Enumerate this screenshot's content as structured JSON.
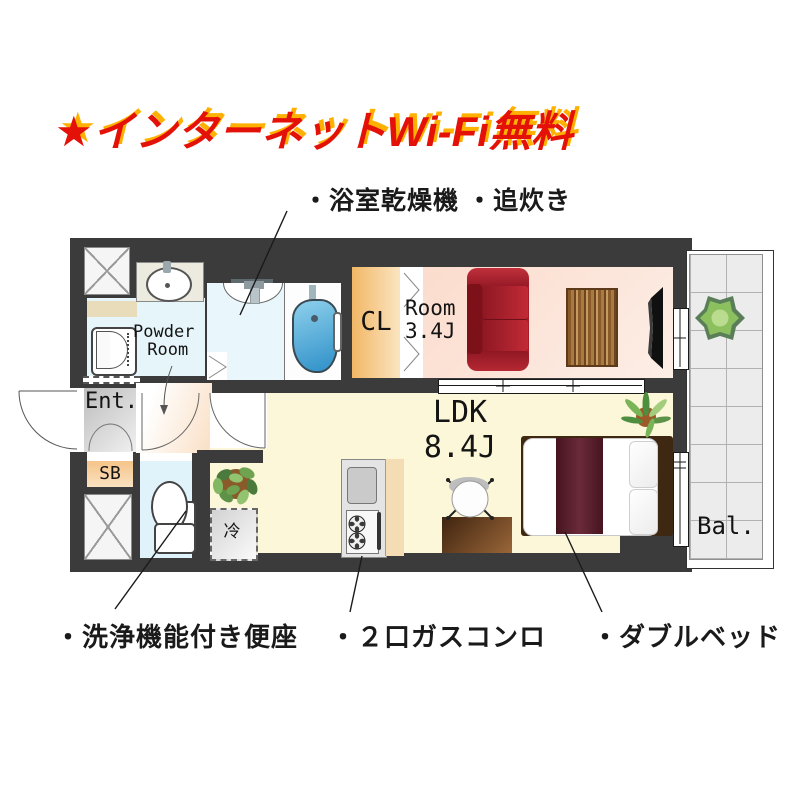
{
  "header": {
    "title": "★インターネットWi-Fi無料",
    "top_annotation": "・浴室乾燥機 ・追炊き"
  },
  "footer_annotations": [
    "・洗浄機能付き便座",
    "・２口ガスコンロ",
    "・ダブルベッド"
  ],
  "floorplan": {
    "labels": {
      "powder_room_line1": "Powder",
      "powder_room_line2": "Room",
      "entrance": "Ent.",
      "shoe_box": "SB",
      "closet": "CL",
      "room_name": "Room",
      "room_size": "3.4J",
      "ldk_name": "LDK",
      "ldk_size": "8.4J",
      "balcony": "Bal.",
      "refrigerator": "冷"
    },
    "colors": {
      "wall": "#3b3b3b",
      "room_pink": "#fce1d4",
      "ldk_yellow": "#fbf7d8",
      "wet_area_blue": "#e6f5fa",
      "closet_orange": "#f2b766",
      "shoebox_orange": "#f5c488",
      "bathtub_blue": "#3f9fd4",
      "sofa_red": "#a91d28",
      "bed_maroon": "#511d2b",
      "wood_brown": "#8a5a28",
      "title_red": "#e41108",
      "title_shadow_orange": "#ffb101"
    }
  }
}
